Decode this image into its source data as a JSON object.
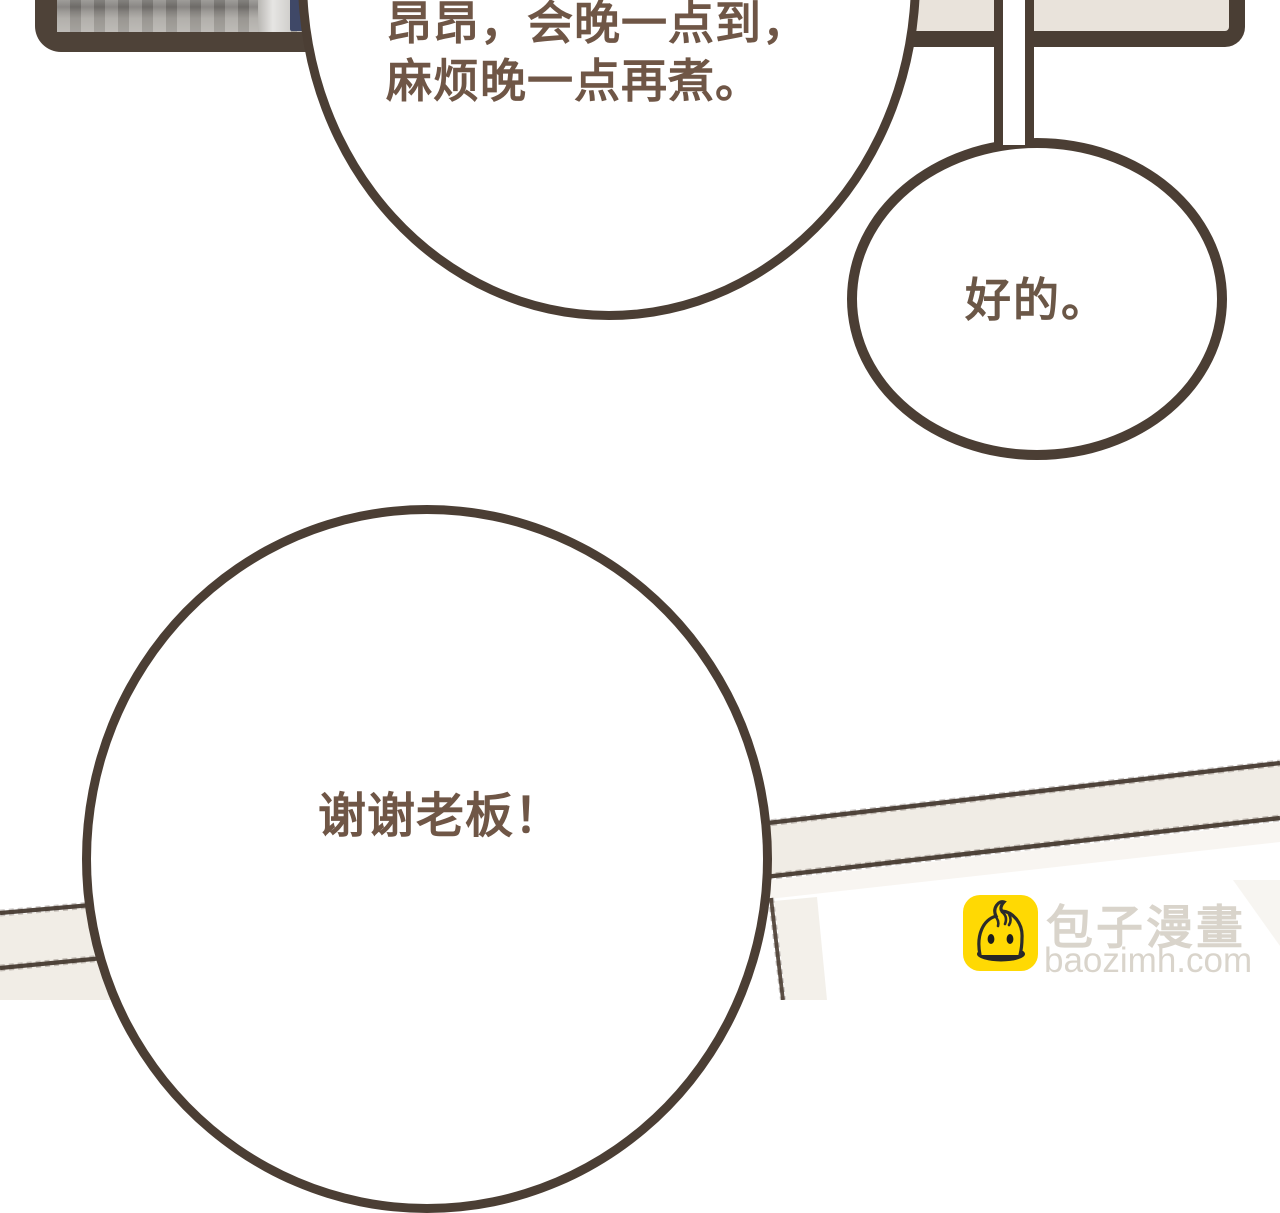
{
  "page": {
    "kind": "webtoon-comic-panel",
    "background": "#ffffff"
  },
  "colors": {
    "outline_brown": "#4b3e34",
    "bubble_fill": "#ffffff",
    "speech_text_brown": "#6f5646",
    "panel_cream": "#e9e3db",
    "gutter_cream": "#f1ede6",
    "photo_navy": "#3f4867",
    "photo_gray": "#a5a29d",
    "watermark_gray": "#d9d4cb",
    "brand_yellow": "#ffd903"
  },
  "bubbles": {
    "main": {
      "line1": "昂昂，会晚一点到，",
      "line2": "麻烦晚一点再煮。"
    },
    "reply": {
      "text": "好的。"
    },
    "thanks": {
      "text": "谢谢老板！"
    }
  },
  "watermark": {
    "brand_cn": "包子漫畫",
    "brand_url": "baozimh.com",
    "icon": "baozi-bun-icon"
  }
}
